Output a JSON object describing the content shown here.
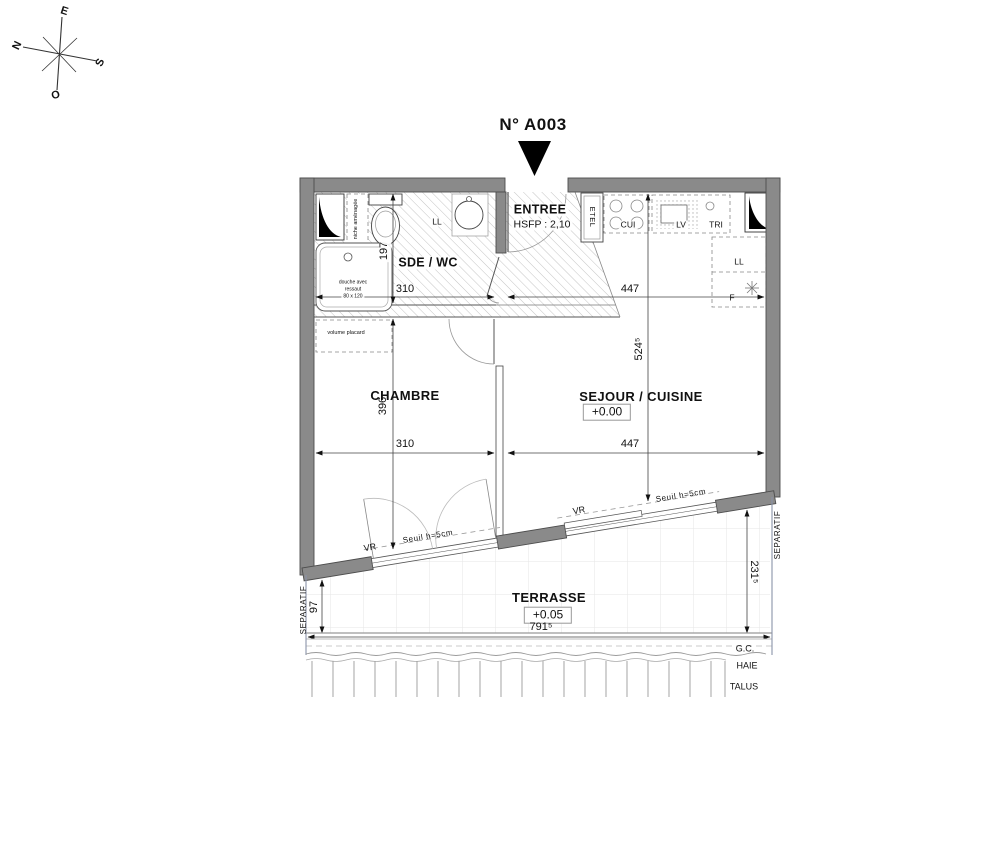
{
  "title": "N° A003",
  "compass": {
    "north": "N",
    "east": "E",
    "south": "S",
    "west": "O"
  },
  "rooms": {
    "sde_wc": {
      "name": "SDE / WC"
    },
    "entree": {
      "name": "ENTREE",
      "ceiling_height": "HSFP : 2,10"
    },
    "chambre": {
      "name": "CHAMBRE"
    },
    "sejour_cuisine": {
      "name": "SEJOUR / CUISINE",
      "level": "+0.00"
    },
    "terrasse": {
      "name": "TERRASSE",
      "level": "+0.05"
    }
  },
  "equipment": {
    "niche": "niche aménagée",
    "shower_line1": "douche avec",
    "shower_line2": "ressaut",
    "shower_line3": "80 x 120",
    "washer_sde": "LL",
    "washer_kitchen": "LL",
    "fridge": "F",
    "tall_unit": "ETEL",
    "hob": "CUI",
    "dishwasher": "LV",
    "bin": "TRI",
    "closet": "volume placard"
  },
  "dimensions": {
    "sde_width": "310",
    "sde_depth": "197",
    "kitchen_width": "447",
    "sejour_depth": "524⁵",
    "chambre_width": "310",
    "chambre_depth": "396",
    "sejour_width": "447",
    "terrace_depth_right": "231⁵",
    "terrace_depth_left": "97",
    "terrace_width": "791⁵"
  },
  "annotations": {
    "shutter_chambre": "VR",
    "shutter_sejour": "VR",
    "threshold_chambre": "Seuil h=5cm",
    "threshold_sejour": "Seuil h=5cm",
    "separatif_left": "SEPARATIF",
    "separatif_right": "SEPARATIF",
    "gc": "G.C.",
    "hedge": "HAIE",
    "slope": "TALUS"
  },
  "colors": {
    "wall": "#8a8a8a",
    "text": "#111111",
    "hatch": "#c4c4c4"
  }
}
